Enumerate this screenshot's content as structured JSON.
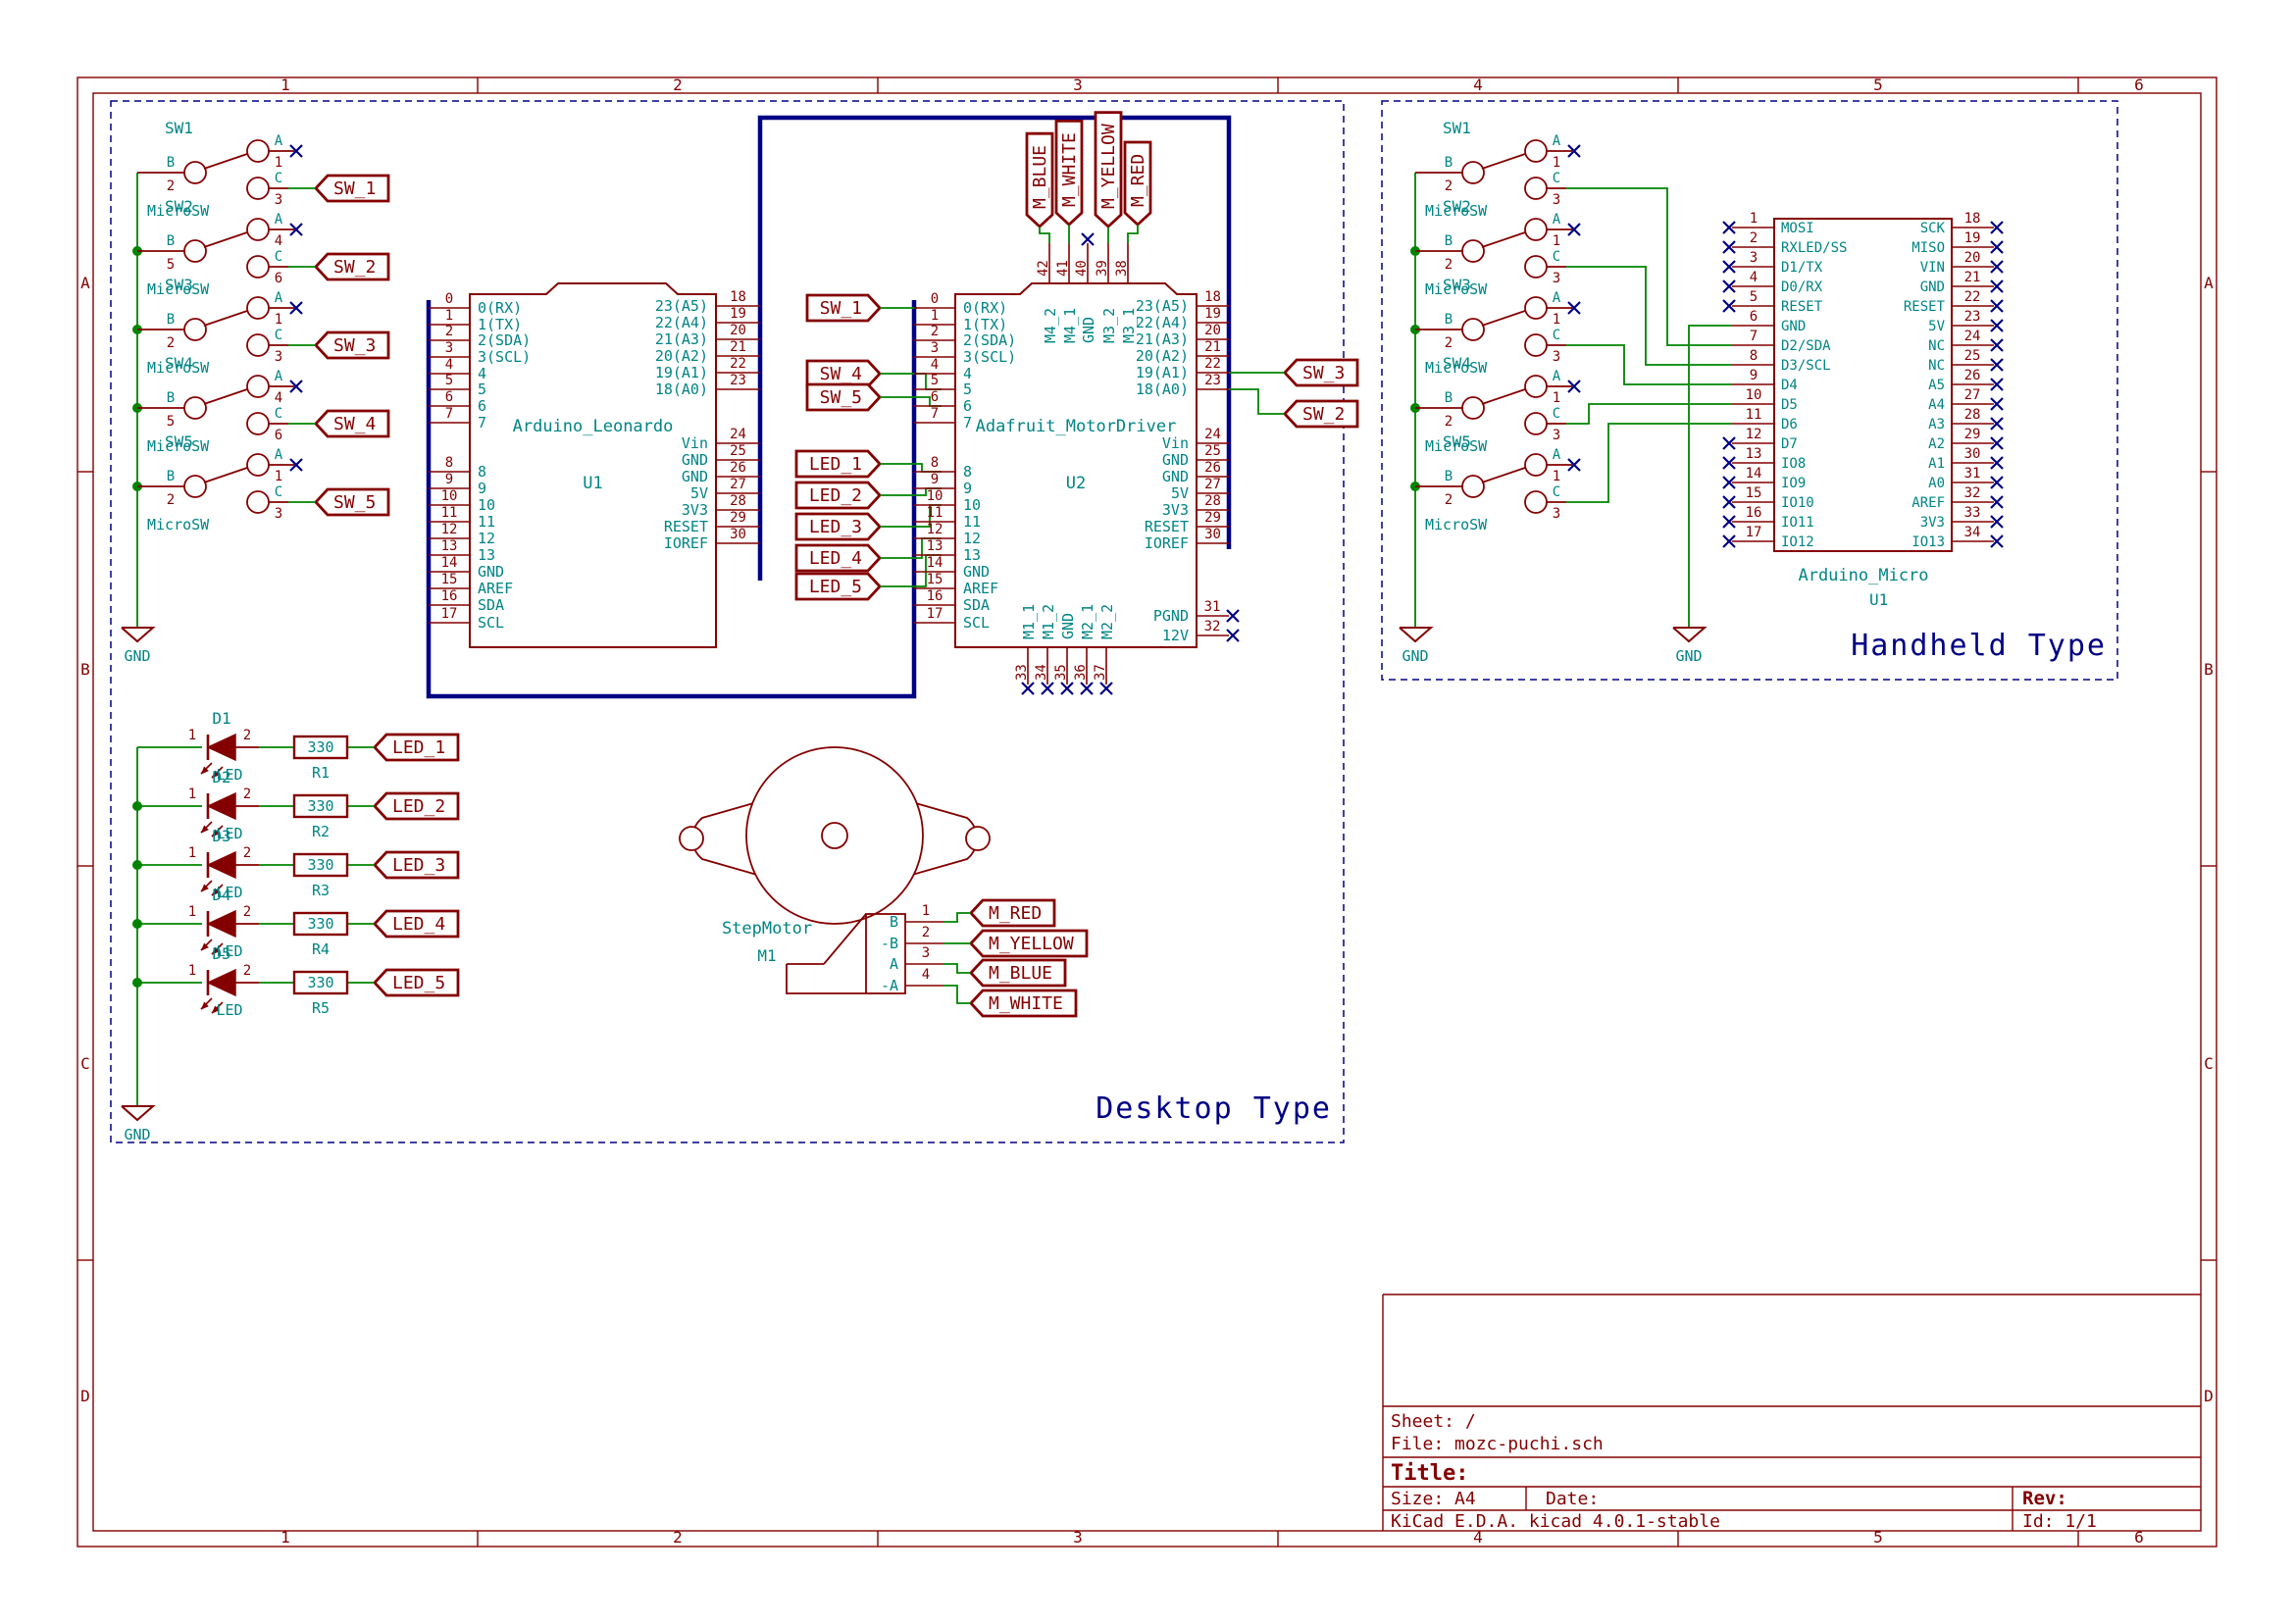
{
  "colors": {
    "outline": "#840000",
    "labels_text": "#008484",
    "wire": "#008400",
    "bus": "#000084",
    "no_connect": "#000084"
  },
  "frame": {
    "cols": [
      "1",
      "2",
      "3",
      "4",
      "5",
      "6"
    ],
    "rows": [
      "A",
      "B",
      "C",
      "D"
    ]
  },
  "title_block": {
    "sheet": "Sheet: /",
    "file": "File: mozc-puchi.sch",
    "title_label": "Title:",
    "size": "Size: A4",
    "date": "Date:",
    "kicad": "KiCad E.D.A.  kicad 4.0.1-stable",
    "rev_label": "Rev:",
    "id": "Id: 1/1"
  },
  "gnd": "GND",
  "switch_pin_letters": {
    "a": "A",
    "b": "B",
    "c": "C"
  },
  "desktop": {
    "section_label": "Desktop Type",
    "switches": [
      {
        "ref": "SW1",
        "value": "MicroSW",
        "pin_a": "1",
        "pin_b": "2",
        "pin_c": "3",
        "tag": "SW_1"
      },
      {
        "ref": "SW2",
        "value": "MicroSW",
        "pin_a": "4",
        "pin_b": "5",
        "pin_c": "6",
        "tag": "SW_2"
      },
      {
        "ref": "SW3",
        "value": "MicroSW",
        "pin_a": "1",
        "pin_b": "2",
        "pin_c": "3",
        "tag": "SW_3"
      },
      {
        "ref": "SW4",
        "value": "MicroSW",
        "pin_a": "4",
        "pin_b": "5",
        "pin_c": "6",
        "tag": "SW_4"
      },
      {
        "ref": "SW5",
        "value": "MicroSW",
        "pin_a": "1",
        "pin_b": "2",
        "pin_c": "3",
        "tag": "SW_5"
      }
    ],
    "leds": [
      {
        "ref": "D1",
        "value": "LED",
        "pin1": "1",
        "pin2": "2",
        "res_ref": "R1",
        "res_value": "330",
        "tag": "LED_1"
      },
      {
        "ref": "D2",
        "value": "LED",
        "pin1": "1",
        "pin2": "2",
        "res_ref": "R2",
        "res_value": "330",
        "tag": "LED_2"
      },
      {
        "ref": "D3",
        "value": "LED",
        "pin1": "1",
        "pin2": "2",
        "res_ref": "R3",
        "res_value": "330",
        "tag": "LED_3"
      },
      {
        "ref": "D4",
        "value": "LED",
        "pin1": "1",
        "pin2": "2",
        "res_ref": "R4",
        "res_value": "330",
        "tag": "LED_4"
      },
      {
        "ref": "D5",
        "value": "LED",
        "pin1": "1",
        "pin2": "2",
        "res_ref": "R5",
        "res_value": "330",
        "tag": "LED_5"
      }
    ],
    "u1": {
      "ref": "U1",
      "name": "Arduino_Leonardo",
      "left": [
        {
          "n": "0",
          "name": "0(RX)"
        },
        {
          "n": "1",
          "name": "1(TX)"
        },
        {
          "n": "2",
          "name": "2(SDA)"
        },
        {
          "n": "3",
          "name": "3(SCL)"
        },
        {
          "n": "4",
          "name": "4"
        },
        {
          "n": "5",
          "name": "5"
        },
        {
          "n": "6",
          "name": "6"
        },
        {
          "n": "7",
          "name": "7"
        },
        {
          "n": "8",
          "name": "8"
        },
        {
          "n": "9",
          "name": "9"
        },
        {
          "n": "10",
          "name": "10"
        },
        {
          "n": "11",
          "name": "11"
        },
        {
          "n": "12",
          "name": "12"
        },
        {
          "n": "13",
          "name": "13"
        },
        {
          "n": "14",
          "name": "GND"
        },
        {
          "n": "15",
          "name": "AREF"
        },
        {
          "n": "16",
          "name": "SDA"
        },
        {
          "n": "17",
          "name": "SCL"
        }
      ],
      "right": [
        {
          "n": "18",
          "name": "23(A5)"
        },
        {
          "n": "19",
          "name": "22(A4)"
        },
        {
          "n": "20",
          "name": "21(A3)"
        },
        {
          "n": "21",
          "name": "20(A2)"
        },
        {
          "n": "22",
          "name": "19(A1)"
        },
        {
          "n": "23",
          "name": "18(A0)"
        },
        {
          "n": "24",
          "name": "Vin"
        },
        {
          "n": "25",
          "name": "GND"
        },
        {
          "n": "26",
          "name": "GND"
        },
        {
          "n": "27",
          "name": "5V"
        },
        {
          "n": "28",
          "name": "3V3"
        },
        {
          "n": "29",
          "name": "RESET"
        },
        {
          "n": "30",
          "name": "IOREF"
        }
      ]
    },
    "u2": {
      "ref": "U2",
      "name": "Adafruit_MotorDriver",
      "left": [
        {
          "n": "0",
          "name": "0(RX)"
        },
        {
          "n": "1",
          "name": "1(TX)"
        },
        {
          "n": "2",
          "name": "2(SDA)"
        },
        {
          "n": "3",
          "name": "3(SCL)"
        },
        {
          "n": "4",
          "name": "4"
        },
        {
          "n": "5",
          "name": "5"
        },
        {
          "n": "6",
          "name": "6"
        },
        {
          "n": "7",
          "name": "7"
        },
        {
          "n": "8",
          "name": "8"
        },
        {
          "n": "9",
          "name": "9"
        },
        {
          "n": "10",
          "name": "10"
        },
        {
          "n": "11",
          "name": "11"
        },
        {
          "n": "12",
          "name": "12"
        },
        {
          "n": "13",
          "name": "13"
        },
        {
          "n": "14",
          "name": "GND"
        },
        {
          "n": "15",
          "name": "AREF"
        },
        {
          "n": "16",
          "name": "SDA"
        },
        {
          "n": "17",
          "name": "SCL"
        }
      ],
      "right": [
        {
          "n": "18",
          "name": "23(A5)"
        },
        {
          "n": "19",
          "name": "22(A4)"
        },
        {
          "n": "20",
          "name": "21(A3)"
        },
        {
          "n": "21",
          "name": "20(A2)"
        },
        {
          "n": "22",
          "name": "19(A1)"
        },
        {
          "n": "23",
          "name": "18(A0)"
        },
        {
          "n": "24",
          "name": "Vin"
        },
        {
          "n": "25",
          "name": "GND"
        },
        {
          "n": "26",
          "name": "GND"
        },
        {
          "n": "27",
          "name": "5V"
        },
        {
          "n": "28",
          "name": "3V3"
        },
        {
          "n": "29",
          "name": "RESET"
        },
        {
          "n": "30",
          "name": "IOREF"
        }
      ],
      "right_extra": [
        {
          "n": "31",
          "name": "PGND"
        },
        {
          "n": "32",
          "name": "12V"
        }
      ],
      "top": [
        {
          "n": "42",
          "name": "M4_2",
          "tag": "M_BLUE"
        },
        {
          "n": "41",
          "name": "M4_1",
          "tag": "M_WHITE"
        },
        {
          "n": "40",
          "name": "GND"
        },
        {
          "n": "39",
          "name": "M3_2",
          "tag": "M_YELLOW"
        },
        {
          "n": "38",
          "name": "M3_1",
          "tag": "M_RED"
        }
      ],
      "bottom": [
        {
          "n": "33",
          "name": "M1_1"
        },
        {
          "n": "34",
          "name": "M1_2"
        },
        {
          "n": "35",
          "name": "GND"
        },
        {
          "n": "36",
          "name": "M2_1"
        },
        {
          "n": "37",
          "name": "M2_2"
        }
      ],
      "left_tags": [
        {
          "text": "SW_1"
        },
        {
          "text": "SW_4"
        },
        {
          "text": "SW_5"
        },
        {
          "text": "LED_1"
        },
        {
          "text": "LED_2"
        },
        {
          "text": "LED_3"
        },
        {
          "text": "LED_4"
        },
        {
          "text": "LED_5"
        }
      ],
      "right_tags": [
        {
          "text": "SW_3"
        },
        {
          "text": "SW_2"
        }
      ]
    },
    "motor": {
      "ref": "M1",
      "name": "StepMotor",
      "pins": [
        {
          "n": "1",
          "name": "B",
          "tag": "M_RED"
        },
        {
          "n": "2",
          "name": "-B",
          "tag": "M_YELLOW"
        },
        {
          "n": "3",
          "name": "A",
          "tag": "M_BLUE"
        },
        {
          "n": "4",
          "name": "-A",
          "tag": "M_WHITE"
        }
      ]
    }
  },
  "handheld": {
    "section_label": "Handheld Type",
    "switches": [
      {
        "ref": "SW1",
        "value": "MicroSW",
        "pin_a": "1",
        "pin_b": "2",
        "pin_c": "3"
      },
      {
        "ref": "SW2",
        "value": "MicroSW",
        "pin_a": "1",
        "pin_b": "2",
        "pin_c": "3"
      },
      {
        "ref": "SW3",
        "value": "MicroSW",
        "pin_a": "1",
        "pin_b": "2",
        "pin_c": "3"
      },
      {
        "ref": "SW4",
        "value": "MicroSW",
        "pin_a": "1",
        "pin_b": "2",
        "pin_c": "3"
      },
      {
        "ref": "SW5",
        "value": "MicroSW",
        "pin_a": "1",
        "pin_b": "2",
        "pin_c": "3"
      }
    ],
    "micro": {
      "ref": "U1",
      "name": "Arduino_Micro",
      "left": [
        {
          "n": "1",
          "name": "MOSI",
          "nc": true
        },
        {
          "n": "2",
          "name": "RXLED/SS",
          "nc": true
        },
        {
          "n": "3",
          "name": "D1/TX",
          "nc": true
        },
        {
          "n": "4",
          "name": "D0/RX",
          "nc": true
        },
        {
          "n": "5",
          "name": "RESET",
          "nc": true
        },
        {
          "n": "6",
          "name": "GND"
        },
        {
          "n": "7",
          "name": "D2/SDA"
        },
        {
          "n": "8",
          "name": "D3/SCL"
        },
        {
          "n": "9",
          "name": "D4"
        },
        {
          "n": "10",
          "name": "D5"
        },
        {
          "n": "11",
          "name": "D6"
        },
        {
          "n": "12",
          "name": "D7",
          "nc": true
        },
        {
          "n": "13",
          "name": "IO8",
          "nc": true
        },
        {
          "n": "14",
          "name": "IO9",
          "nc": true
        },
        {
          "n": "15",
          "name": "IO10",
          "nc": true
        },
        {
          "n": "16",
          "name": "IO11",
          "nc": true
        },
        {
          "n": "17",
          "name": "IO12",
          "nc": true
        }
      ],
      "right": [
        {
          "n": "18",
          "name": "SCK"
        },
        {
          "n": "19",
          "name": "MISO"
        },
        {
          "n": "20",
          "name": "VIN"
        },
        {
          "n": "21",
          "name": "GND"
        },
        {
          "n": "22",
          "name": "RESET"
        },
        {
          "n": "23",
          "name": "5V"
        },
        {
          "n": "24",
          "name": "NC"
        },
        {
          "n": "25",
          "name": "NC"
        },
        {
          "n": "26",
          "name": "A5"
        },
        {
          "n": "27",
          "name": "A4"
        },
        {
          "n": "28",
          "name": "A3"
        },
        {
          "n": "29",
          "name": "A2"
        },
        {
          "n": "30",
          "name": "A1"
        },
        {
          "n": "31",
          "name": "A0"
        },
        {
          "n": "32",
          "name": "AREF"
        },
        {
          "n": "33",
          "name": "3V3"
        },
        {
          "n": "34",
          "name": "IO13"
        }
      ]
    }
  }
}
